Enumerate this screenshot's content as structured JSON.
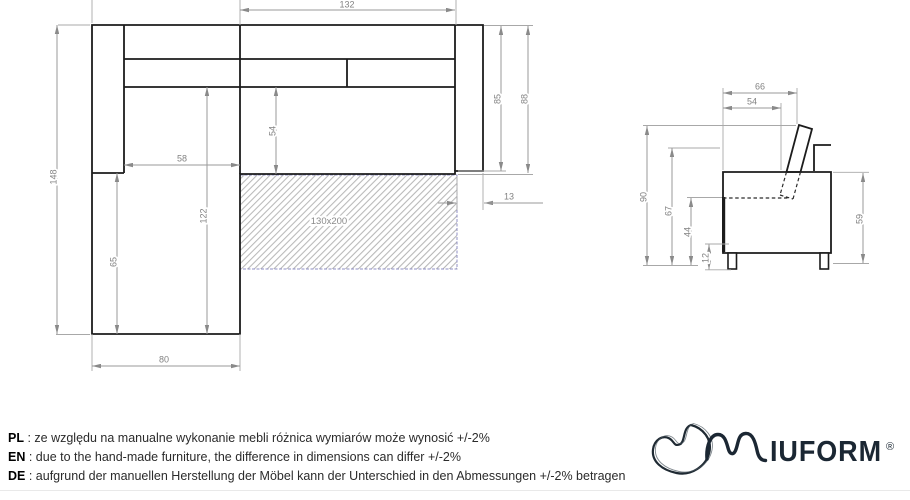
{
  "drawing": {
    "top_view": {
      "mattress_label": "130x200",
      "dims": {
        "back_width": "132",
        "total_depth": "148",
        "chaise_inner_width": "58",
        "seat_depth": "54",
        "chaise_depth": "122",
        "chaise_front_depth": "65",
        "chaise_width": "80",
        "armrest_length": "85",
        "side_length": "88",
        "armrest_offset": "13"
      }
    },
    "side_view": {
      "dims": {
        "arm_top_width": "66",
        "seat_top_width": "54",
        "total_height": "90",
        "back_height": "67",
        "seat_height": "44",
        "leg_height": "12",
        "body_height": "59"
      }
    }
  },
  "footer": {
    "separator": " : ",
    "notes": [
      {
        "lang": "PL",
        "text": "ze względu na manualne wykonanie mebli różnica wymiarów może wynosić +/-2%"
      },
      {
        "lang": "EN",
        "text": "due to the hand-made furniture, the difference in dimensions can differ +/-2%"
      },
      {
        "lang": "DE",
        "text": "aufgrund der manuellen Herstellung der Möbel kann der Unterschied in den Abmessungen +/-2% betragen"
      }
    ]
  },
  "logo": {
    "wordmark": "IUFORM",
    "registered": "®"
  },
  "colors": {
    "bold_line": "#1c1c1c",
    "dim_line": "#9a9a9a",
    "dim_text": "#828282",
    "mattress_border": "#8f8fc4",
    "hatch": "#ababab",
    "logo": "#1b2733"
  }
}
